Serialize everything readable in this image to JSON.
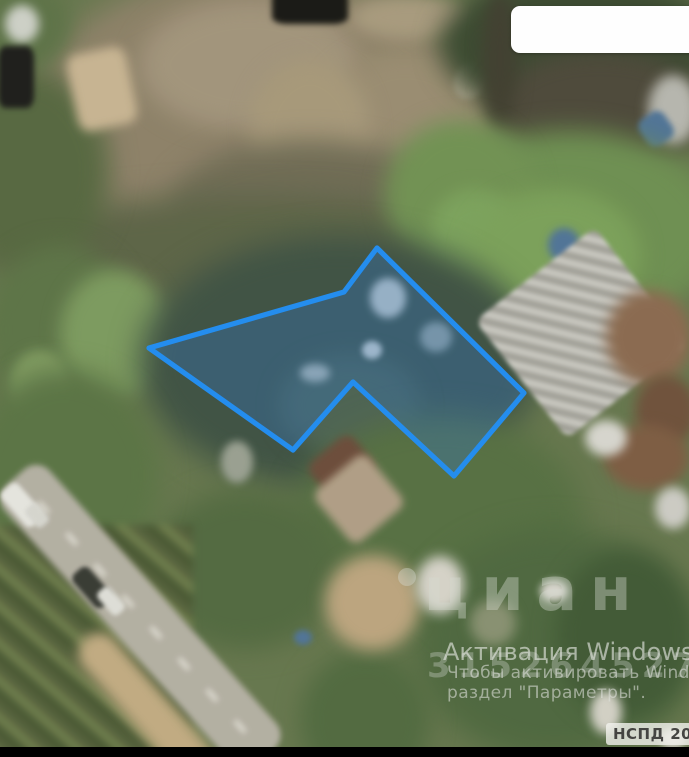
{
  "app": {
    "description": "Satellite map screenshot with a land parcel outlined in blue (НСПД cadastral imagery, cian watermark, Windows activation watermark)"
  },
  "map": {
    "type": "satellite",
    "parcel": {
      "points": "377,248 524,393 454,476 353,382 293,450 149,348 344,292",
      "stroke_color": "#1d8cf2",
      "fill_color": "rgba(45,115,195,0.34)"
    }
  },
  "watermarks": {
    "cian_logo_text": "циан",
    "cian_pin_icon": "map-pin-icon",
    "id_digits": "315264527",
    "activation_line1": "Активация Windows",
    "activation_line2": "Чтобы активировать Wind",
    "activation_line3": "раздел \"Параметры\"."
  },
  "badge": {
    "label": "НСПД 2025"
  }
}
